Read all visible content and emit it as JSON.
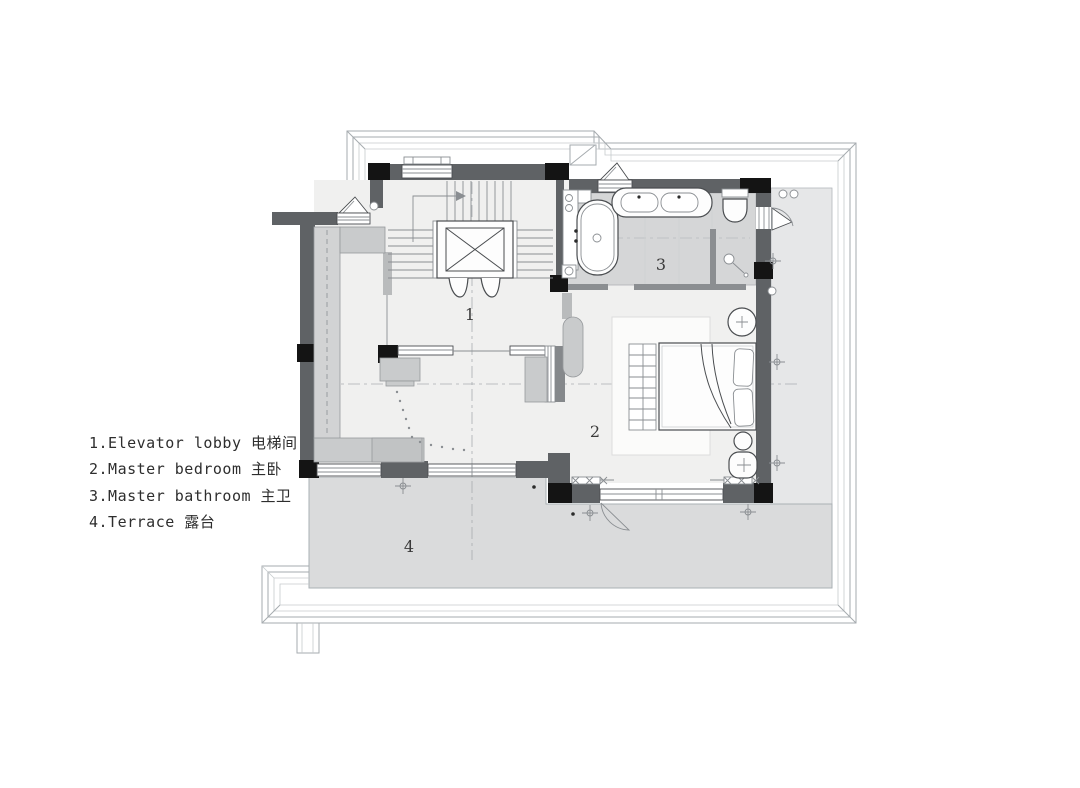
{
  "legend": {
    "items": [
      {
        "label": "1.Elevator lobby 电梯间"
      },
      {
        "label": "2.Master bedroom 主卧"
      },
      {
        "label": "3.Master bathroom 主卫"
      },
      {
        "label": "4.Terrace 露台"
      }
    ]
  },
  "rooms": {
    "elevator_lobby": "1",
    "master_bedroom": "2",
    "master_bathroom": "3",
    "terrace": "4"
  },
  "colors": {
    "background": "#ffffff",
    "wall": "#5f6265",
    "column": "#141414",
    "floor": "#f0f0ef",
    "bathroom_floor": "#d5d6d7",
    "terrace_floor": "#dadbdc",
    "roof_strip": "#e6e7e8",
    "cabinet": "#c9cbcc",
    "wardrobe": "#d2d3d4",
    "line_dark": "#4a4d50",
    "line_mid": "#8a8e92",
    "line_roof": "#a6abaf",
    "text": "#2e2e2e"
  }
}
